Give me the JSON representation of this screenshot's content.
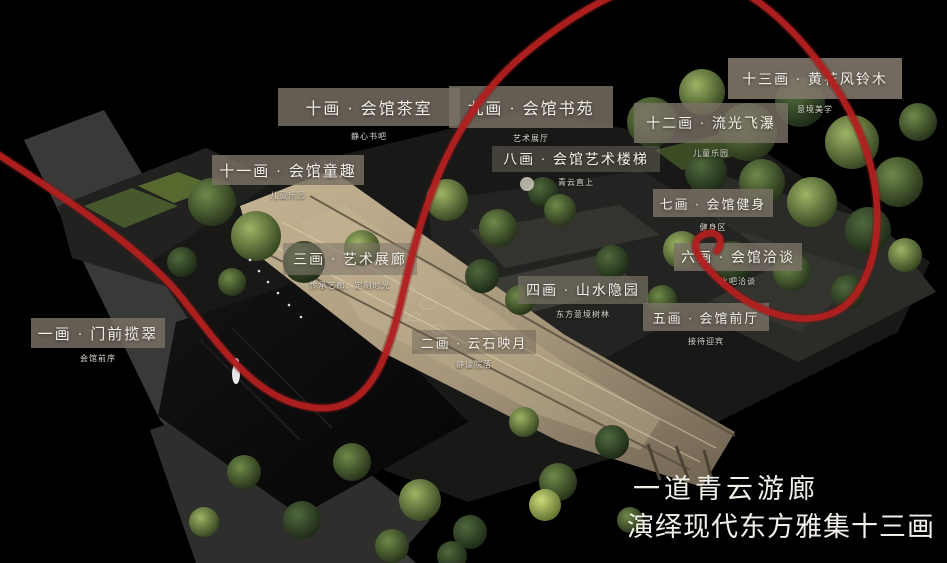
{
  "caption": {
    "line1": "一道青云游廊",
    "line2": "演绎现代东方雅集十三画"
  },
  "labels": [
    {
      "title": "一画 · 门前揽翠",
      "subtitle": "会馆前序"
    },
    {
      "title": "二画 · 云石映月",
      "subtitle": "静谧院落"
    },
    {
      "title": "三画 · 艺术展廊",
      "subtitle": "传承艺廊、定制时光"
    },
    {
      "title": "四画 · 山水隐园",
      "subtitle": "东方意境树林"
    },
    {
      "title": "五画 · 会馆前厅",
      "subtitle": "接待迎宾"
    },
    {
      "title": "六画 · 会馆洽谈",
      "subtitle": "水吧洽谈"
    },
    {
      "title": "七画 · 会馆健身",
      "subtitle": "健身区"
    },
    {
      "title": "八画 · 会馆艺术楼梯",
      "subtitle": "青云直上"
    },
    {
      "title": "九画 · 会馆书苑",
      "subtitle": "艺术展厅"
    },
    {
      "title": "十画 · 会馆茶室",
      "subtitle": "静心书吧"
    },
    {
      "title": "十一画 · 会馆童趣",
      "subtitle": "儿童乐园"
    },
    {
      "title": "十二画 · 流光飞瀑",
      "subtitle": "儿童乐园"
    },
    {
      "title": "十三画 · 黄花风铃木",
      "subtitle": "意境美学"
    }
  ],
  "colors": {
    "background": "#000000",
    "accent_red_curve": "#b22020",
    "label_box": "#7a7165",
    "gallery_gold": "#b3a283",
    "caption_text": "#f2efe8"
  }
}
